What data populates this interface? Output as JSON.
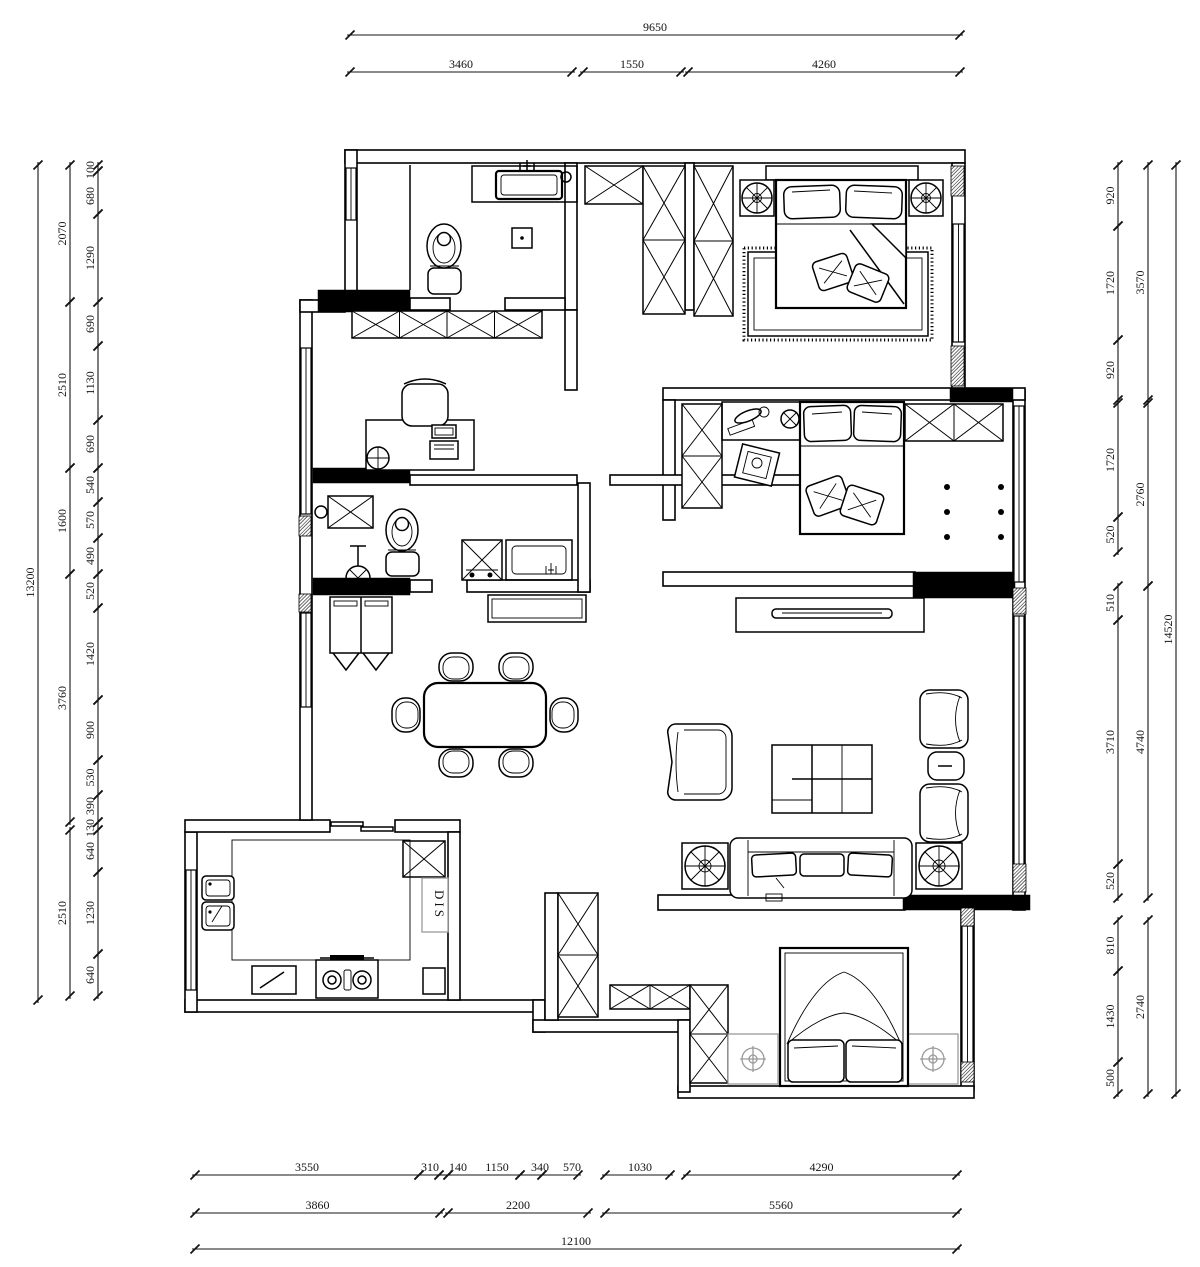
{
  "plan": {
    "dis_label": "DIS"
  },
  "dimensions": {
    "top_total": "9650",
    "top_row": [
      "3460",
      "1550",
      "4260"
    ],
    "bottom_row1": [
      "3550",
      "310",
      "140",
      "1150",
      "340",
      "570",
      "1030",
      "4290"
    ],
    "bottom_row2": [
      "3860",
      "2200",
      "5560"
    ],
    "bottom_total": "12100",
    "left_outer": "13200",
    "left_mid": [
      "2070",
      "2510",
      "1600",
      "3760",
      "2510"
    ],
    "left_inner": [
      "100",
      "680",
      "1290",
      "690",
      "1130",
      "690",
      "540",
      "570",
      "490",
      "520",
      "1420",
      "900",
      "530",
      "390",
      "130",
      "640",
      "1230",
      "640"
    ],
    "right_outer": "14520",
    "right_mid": [
      "3570",
      "2760",
      "4740",
      "2740"
    ],
    "right_inner": [
      "920",
      "1720",
      "920",
      "1720",
      "520",
      "510",
      "3710",
      "520",
      "810",
      "1430",
      "500"
    ]
  }
}
